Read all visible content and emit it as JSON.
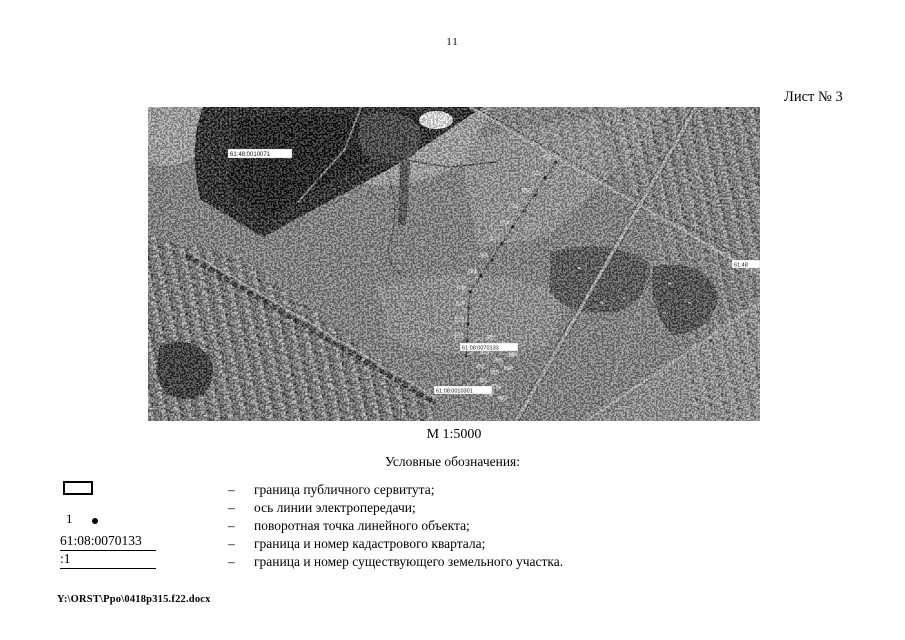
{
  "page": {
    "number": "11",
    "sheet_label": "Лист № 3",
    "footer_path": "Y:\\ORST\\Ppo\\0418p315.f22.docx"
  },
  "map": {
    "scale_caption": "М 1:5000",
    "labels": {
      "quarter_top_left": "61:48:0010071",
      "quarter_center": "61:08:0070133",
      "parcel_bottom": "61:08:0010301",
      "quarter_right_edge": "61:48"
    }
  },
  "legend": {
    "title": "Условные обозначения:",
    "dash": "–",
    "items": [
      {
        "text": "граница публичного сервитута;"
      },
      {
        "text": "ось линии электропередачи;"
      },
      {
        "text": "поворотная точка линейного объекта;"
      },
      {
        "text": "граница и номер кадастрового квартала;"
      },
      {
        "text": "граница и номер существующего земельного участка."
      }
    ],
    "symbols": {
      "point_number": "1",
      "quarter_number": "61:08:0070133",
      "parcel_number": ":1"
    }
  }
}
